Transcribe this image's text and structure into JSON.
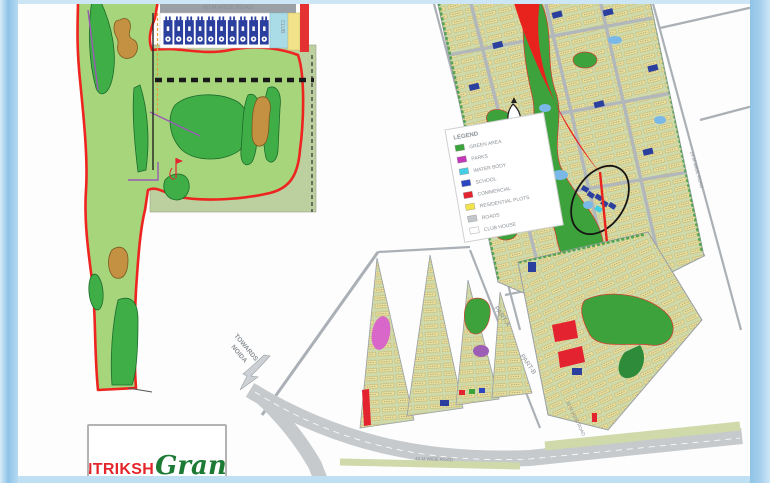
{
  "poster": {
    "brand": {
      "name_part1": "ANTRIKSH",
      "name_part2": "Grand"
    },
    "left_map": {
      "top_road_label": "60 M WIDE ROAD",
      "club_block_label": "CLUB",
      "tower_count": 10
    },
    "legend": {
      "title": "LEGEND",
      "items": [
        {
          "label": "GREEN AREA",
          "color": "#3aa33a"
        },
        {
          "label": "PARKS",
          "color": "#c238b8"
        },
        {
          "label": "WATER BODY",
          "color": "#45cde4"
        },
        {
          "label": "SCHOOL",
          "color": "#2a46c0"
        },
        {
          "label": "COMMERCIAL",
          "color": "#e3232f"
        },
        {
          "label": "RESIDENTIAL PLOTS",
          "color": "#f3e34a"
        },
        {
          "label": "ROADS",
          "color": "#c3c7cb"
        },
        {
          "label": "CLUB HOUSE",
          "color": "#ffffff"
        }
      ]
    },
    "plan": {
      "towards_label_line1": "TOWARDS",
      "towards_label_line2": "NOIDA",
      "part_a_label": "PART-A",
      "part_b_label": "PART-B",
      "road_labels": [
        "60 M WIDE ROAD",
        "24 M WIDE ROAD",
        "45 M WIDE ROAD",
        "30 M WIDE ROAD"
      ]
    },
    "colors": {
      "frame_blue": "#9fcdec",
      "boundary_red": "#ee2420",
      "golf_light_green": "#a6d57c",
      "golf_dark_green": "#3fae47",
      "bunker_tan": "#c49041",
      "plan_base_green": "#cfd9a9",
      "road_gray": "#b4b9bd",
      "building_blue": "#2b3f9e",
      "water_blue": "#7ab8e8",
      "logo_red": "#e4262c",
      "logo_green": "#1d7a35"
    }
  }
}
